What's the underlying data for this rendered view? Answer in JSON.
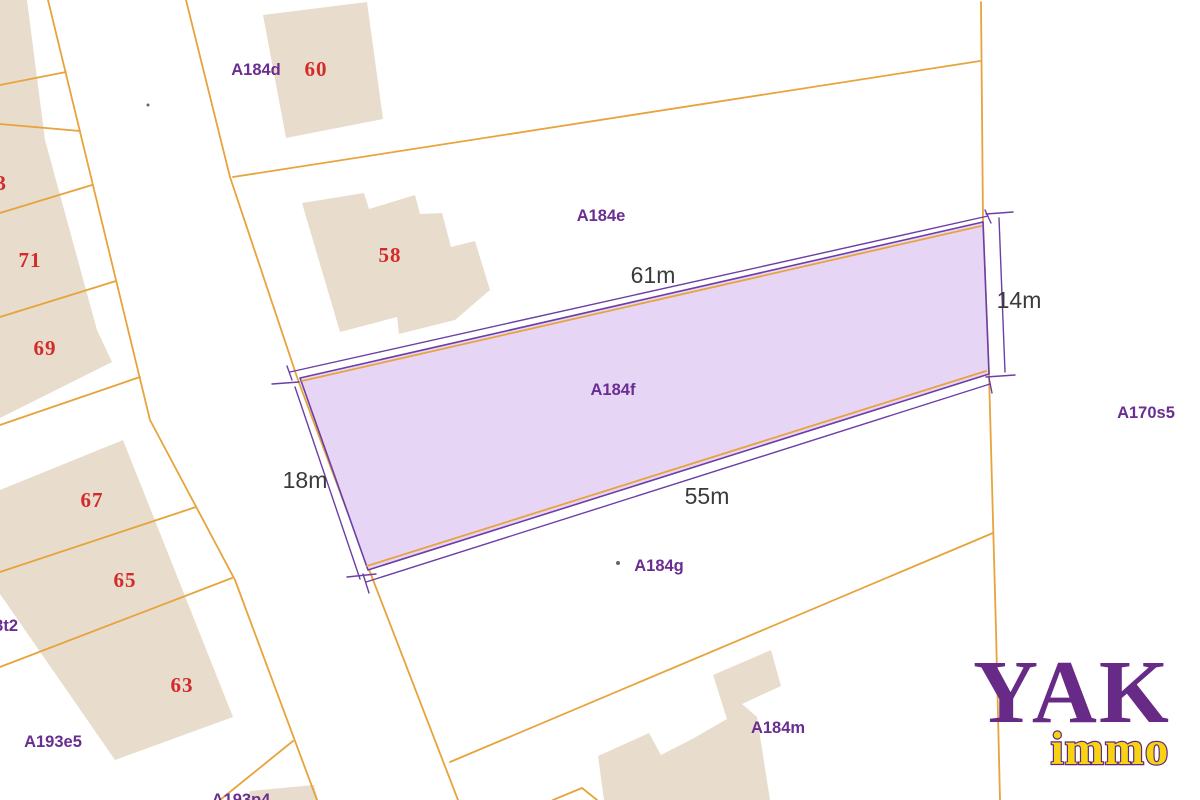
{
  "map": {
    "type": "cadastral-parcel-map",
    "highlighted_parcel": {
      "label": "A184f",
      "dim_top": "61m",
      "dim_bottom": "55m",
      "dim_left": "18m",
      "dim_right": "14m"
    },
    "parcel_labels": {
      "a184d": "A184d",
      "a184e": "A184e",
      "a184g": "A184g",
      "a184m": "A184m",
      "a170s5": "A170s5",
      "a193e5": "A193e5",
      "a193p4": "A193p4",
      "a193t2": "A193t2"
    },
    "house_numbers": {
      "n60": "60",
      "n58": "58",
      "n73": "73",
      "n71": "71",
      "n69": "69",
      "n67": "67",
      "n65": "65",
      "n63": "63"
    }
  },
  "logo": {
    "name": "YAK",
    "sub": "immo"
  },
  "colors": {
    "boundary_line": "#e7a33c",
    "parcel_outline": "#6b3fa6",
    "parcel_fill": "#e7d5f5",
    "building_fill": "#e8ddcc",
    "parcel_label": "#6a2d91",
    "house_number": "#d32b2b",
    "dimension_text": "#3b3b3b",
    "logo_primary": "#682a87",
    "logo_accent": "#f7d312"
  }
}
